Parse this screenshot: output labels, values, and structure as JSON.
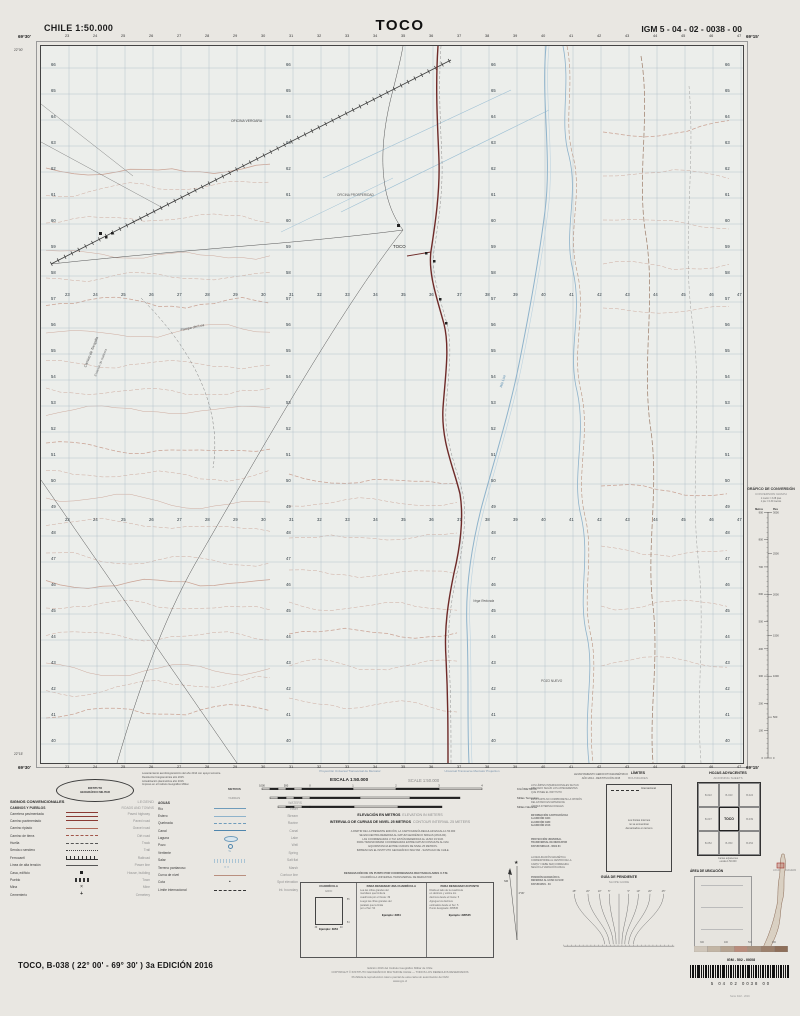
{
  "header": {
    "left": "CHILE  1:50.000",
    "title": "TOCO",
    "right": "IGM 5 - 04 - 02 - 0038 - 00"
  },
  "map": {
    "eastings": [
      23,
      24,
      25,
      26,
      27,
      28,
      29,
      30,
      31,
      32,
      33,
      34,
      35,
      36,
      37,
      38,
      39,
      40,
      41,
      42,
      43,
      44,
      45,
      46,
      47
    ],
    "northings": [
      40,
      41,
      42,
      43,
      44,
      45,
      46,
      47,
      48,
      49,
      50,
      51,
      52,
      53,
      54,
      55,
      56,
      57,
      58,
      59,
      60,
      61,
      62,
      63,
      64,
      65,
      66
    ],
    "corners": {
      "top_left_lon": "69°30'",
      "top_right_lon": "69°15'",
      "bottom_left_lon": "69°30'",
      "bottom_right_lon": "69°15'",
      "top_lat": "22°00'",
      "bottom_lat": "22°15'"
    },
    "labels": [
      {
        "t": "OFICINA VERGARA",
        "x": 190,
        "y": 76,
        "s": 3.4,
        "r": 0,
        "c": "#4a4a4a"
      },
      {
        "t": "OFICINA PROSPERIDAD",
        "x": 296,
        "y": 150,
        "s": 3.2,
        "r": 0,
        "c": "#555555"
      },
      {
        "t": "Camino de Tocopilla",
        "x": 46,
        "y": 322,
        "s": 3.6,
        "r": -68,
        "c": "#4a4a4a"
      },
      {
        "t": "Estación de Salitrera",
        "x": 56,
        "y": 330,
        "s": 3.2,
        "r": -68,
        "c": "#6a6a6a"
      },
      {
        "t": "TOCO",
        "x": 352,
        "y": 202,
        "s": 4.4,
        "r": 0,
        "c": "#222222"
      },
      {
        "t": "Pampa del Loa",
        "x": 140,
        "y": 286,
        "s": 3.6,
        "r": -12,
        "c": "#555555"
      },
      {
        "t": "Río Loa",
        "x": 462,
        "y": 342,
        "s": 3.6,
        "r": -74,
        "c": "#4f86ad"
      },
      {
        "t": "Vega Redonda",
        "x": 432,
        "y": 556,
        "s": 3.2,
        "r": 0,
        "c": "#555555"
      },
      {
        "t": "POZO NUEVO",
        "x": 500,
        "y": 636,
        "s": 3.2,
        "r": 0,
        "c": "#555555"
      }
    ]
  },
  "conversion": {
    "title": "GRÁFICO DE CONVERSIÓN",
    "subtitle": "CONVERSION GRAPH",
    "notes": [
      "1 metro = 3.28 pies",
      "1 pie = 0.30 metros"
    ],
    "left_unit": "Metros",
    "right_unit": "Pies",
    "meters_max": 900,
    "feet_max": 3000
  },
  "scale": {
    "proj_es": "Proyección Universal Transversal de Mercator",
    "proj_en": "Universal Transverse Mercator Projection",
    "escala": "ESCALA 1:50.000",
    "escala_en": "SCALE 1:50.000",
    "left_label_1": "METROS",
    "left_label_2": "YARDAS",
    "bar_right_labels": [
      "KILÓMETROS",
      "Millas Terrestres",
      "Millas Náuticas"
    ],
    "row1_ticks": [
      "1000",
      "500",
      "0",
      "1",
      "2",
      "3",
      "4"
    ],
    "elev_es": "ELEVACIÓN EN METROS",
    "elev_en": "ELEVATION IN METERS",
    "int_es": "INTERVALO DE CURVAS DE NIVEL 25 METROS",
    "int_en": "CONTOUR INTERVAL 25 METERS"
  },
  "legend": {
    "title": "SIGNOS CONVENCIONALES",
    "title_en": "LEGEND",
    "col1_header": "CAMINOS Y PUEBLOS",
    "col1_header_en": "ROADS AND TOWNS",
    "col2_header": "AGUAS",
    "col2_header_en": "WATERS",
    "col1": [
      {
        "es": "Carretera pavimentada",
        "en": "Paved highway",
        "sym": "road2"
      },
      {
        "es": "Camino pavimentado",
        "en": "Paved road",
        "sym": "road1"
      },
      {
        "es": "Camino ripiado",
        "en": "Gravel road",
        "sym": "gravel"
      },
      {
        "es": "Camino de tierra",
        "en": "Dirt road",
        "sym": "dirt"
      },
      {
        "es": "Huella",
        "en": "Track",
        "sym": "dash"
      },
      {
        "es": "Senda o sendero",
        "en": "Trail",
        "sym": "dots"
      },
      {
        "es": "Ferrocarril",
        "en": "Railroad",
        "sym": "rail"
      },
      {
        "es": "Línea de alta tensión",
        "en": "Power line",
        "sym": "power"
      },
      {
        "es": "Casa, edificio",
        "en": "House, building",
        "sym": "sq"
      },
      {
        "es": "Pueblo",
        "en": "Town",
        "sym": "town"
      },
      {
        "es": "Mina",
        "en": "Mine",
        "sym": "mine"
      },
      {
        "es": "Cementerio",
        "en": "Cemetery",
        "sym": "cem"
      }
    ],
    "col2": [
      {
        "es": "Río",
        "en": "River",
        "sym": "river"
      },
      {
        "es": "Estero",
        "en": "Stream",
        "sym": "stream"
      },
      {
        "es": "Quebrada",
        "en": "Ravine",
        "sym": "qdash"
      },
      {
        "es": "Canal",
        "en": "Canal",
        "sym": "canal"
      },
      {
        "es": "Laguna",
        "en": "Lake",
        "sym": "lake"
      },
      {
        "es": "Pozo",
        "en": "Well",
        "sym": "well"
      },
      {
        "es": "Vertiente",
        "en": "Spring",
        "sym": "spring"
      },
      {
        "es": "Salar",
        "en": "Salt flat",
        "sym": "salar"
      },
      {
        "es": "Terreno pantanoso",
        "en": "Marsh",
        "sym": "marsh"
      },
      {
        "es": "Curva de nivel",
        "en": "Contour line",
        "sym": "contour"
      },
      {
        "es": "Cota",
        "en": "Spot elevation",
        "sym": "spot"
      },
      {
        "es": "Límite internacional",
        "en": "Int. boundary",
        "sym": "bound"
      }
    ]
  },
  "limits": {
    "title": "LÍMITES",
    "subtitle": "BOUNDARIES",
    "sample_label": "Internacional",
    "box_lines": [
      "Los límites internos",
      "no se encuentran",
      "demarcados en terreno"
    ],
    "note1": [
      "LOS LÍMITES INTERNACIONALES SE HAN",
      "DIBUJADO SEGÚN LOS ANTECEDENTES",
      "QUE POSEE EL INSTITUTO"
    ],
    "note2": [
      "ESTA CARTA NO COMPROMETE LA OPINIÓN",
      "DEL ESTADO EN MATERIA DE",
      "LÍMITES INTERNACIONALES"
    ]
  },
  "sheets": {
    "title": "HOJAS ADYACENTES",
    "subtitle": "ADJOINING SHEETS",
    "cells": [
      "B-022",
      "B-023",
      "B-024",
      "B-037",
      "TOCO",
      "B-039",
      "B-052",
      "B-053",
      "B-054"
    ],
    "note": [
      "Cartas adyacentes",
      "escala 1:50.000"
    ]
  },
  "location": {
    "title": "ÁREA DE UBICACIÓN",
    "subtitle": "LOCATION DIAGRAM",
    "mark": "TOCO"
  },
  "slope": {
    "title": "GUÍA DE PENDIENTE",
    "subtitle": "SLOPE GUIDE",
    "deg_labels": [
      "45°",
      "20°",
      "10°",
      "5°",
      "5°",
      "10°",
      "20°",
      "45°"
    ]
  },
  "declination": {
    "lines": [
      "NORTE MAGNÉTICO",
      "DICIEMBRE 2016",
      "DECLINACIÓN MEDIA",
      "4° 30' AL ESTE",
      "VARIACIÓN ANUAL",
      "8' AL OESTE"
    ],
    "note": [
      "LA DECLINACIÓN MAGNÉTICA",
      "CORRESPONDE AL CENTRO DE LA",
      "CARTA Y DEBE SER CORREGIDA",
      "SEGÚN LA VARIACIÓN ANUAL"
    ]
  },
  "info_blocks": {
    "photogrammetry": [
      "Levantamiento aerofotogramétrico del año 2014 con apoyo terrestre.",
      "Restitución fotogramétrica año 2015.",
      "Actualización planimétrica año 2016.",
      "Impreso en el Instituto Geográfico Militar."
    ],
    "survey_right": [
      "LEVANTAMIENTO AEROFOTOGRAMÉTRICO",
      "AÑO 2014 - RESTITUCIÓN 2015"
    ],
    "cartographic": [
      "INFORMACIÓN CARTOGRÁFICA",
      "1a EDICIÓN 1964",
      "2a EDICIÓN 1980",
      "3a EDICIÓN 2016"
    ],
    "projection": [
      "PROYECCIÓN UNIVERSAL",
      "TRANSVERSAL DE MERCATOR",
      "DATUM SIRGAS - WGS 84"
    ],
    "position": [
      "POSICIÓN GEOGRÁFICA",
      "REFERIDA AL HUSO 19 SUR",
      "DATUM WGS - 84"
    ],
    "center": [
      "A PARTIR DE LA PRESENTE EDICIÓN, LA CARTOGRAFÍA REGULAR ESCALA 1:50.000",
      "SE ENCUENTRA REFERIDA AL DATUM GEODÉSICO SIRGAS (WGS-84).",
      "LAS COORDENADAS U.T.M. ESTÁN REFERIDAS AL HUSO 19 SUR.",
      "PARA TRANSFORMAR COORDENADAS ENTRE DATUM CONSULTE AL IGM.",
      "EQUIDISTANCIA ENTRE CURVAS DE NIVEL 25 METROS.",
      "IMPRESO EN EL INSTITUTO GEOGRÁFICO MILITAR - SANTIAGO DE CHILE."
    ]
  },
  "gridbox": {
    "h1": "DESIGNACIÓN DE UN PUNTO POR COORDENADAS RECTANGULARES U.T.M.",
    "h2": "CUADRÍCULA UNIVERSAL TRANSVERSAL DE MERCATOR",
    "col1_title": "CUADRÍCULA",
    "col1_sub": "GRID",
    "sq_labels": [
      "39",
      "40",
      "54",
      "55"
    ],
    "col2_title": "PARA DESIGNAR UNA CUADRÍCULA",
    "col2_lines": [
      "Lea las cifras grandes del",
      "meridiano que limita la",
      "cuadrícula por el Oeste: 39",
      "Luego las cifras grandes del",
      "paralelo que la limita",
      "por el Sur: 54"
    ],
    "col2_ex": "Ejemplo: 3954",
    "col3_title": "PARA DESIGNAR UN PUNTO",
    "col3_lines": [
      "Divida el lado de la cuadrícula",
      "en décimos y estime los",
      "décimos desde el Oeste: 5",
      "Agregue los décimos",
      "estimados desde el Sur: 5",
      "Punto designado: 395545"
    ],
    "col3_ex": "Ejemplo: 395545"
  },
  "logo": {
    "line1": "INSTITUTO",
    "line2": "GEOGRÁFICO MILITAR"
  },
  "tintbar": {
    "labels": [
      "300",
      "400",
      "500",
      "600"
    ]
  },
  "footer": {
    "title": "TOCO, B-038 ( 22° 00' - 69° 30' ) 3a EDICIÓN 2016",
    "center_lines": [
      "Edición 2016 del Instituto Geográfico Militar de Chile",
      "COPYRIGHT © INSTITUTO GEOGRÁFICO MILITAR DE CHILE — TODOS LOS DERECHOS RESERVADOS",
      "Prohibida la reproducción total o parcial de esta carta sin autorización del IGM",
      "www.igm.cl"
    ],
    "barcode_label": "IGM - 502 - I0608",
    "barcode_numbers": "5  04  02  0038  00",
    "serie": "Serie IGM - 2016"
  }
}
